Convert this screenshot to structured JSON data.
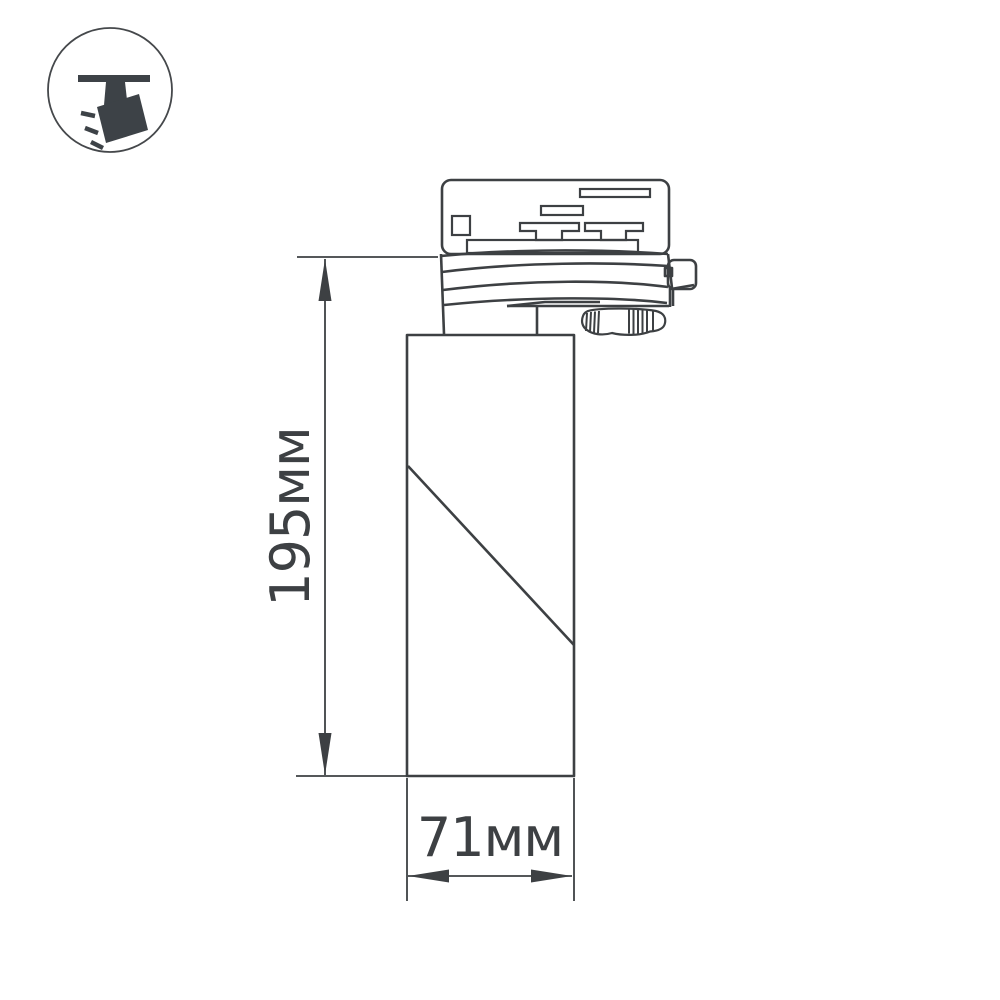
{
  "colors": {
    "background": "#ffffff",
    "line": "#3d4043",
    "icon": "#3d4247"
  },
  "icon": {
    "name": "ceiling-track-spotlight"
  },
  "dimensions": {
    "height": {
      "label": "195мм",
      "value_mm": 195
    },
    "width": {
      "label": "71мм",
      "value_mm": 71
    }
  }
}
